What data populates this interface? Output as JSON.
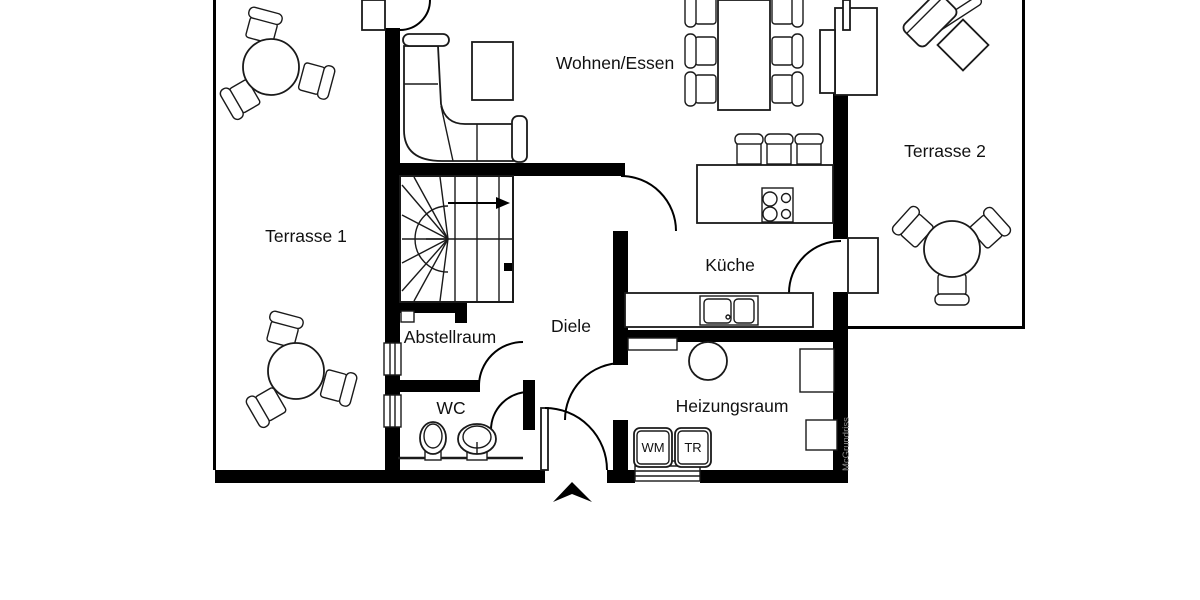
{
  "floorplan": {
    "type": "floor-plan",
    "rooms": {
      "terrasse1": {
        "label": "Terrasse 1"
      },
      "wohnen_essen": {
        "label": "Wohnen/Essen"
      },
      "terrasse2": {
        "label": "Terrasse 2"
      },
      "kueche": {
        "label": "Küche"
      },
      "diele": {
        "label": "Diele"
      },
      "abstellraum": {
        "label": "Abstellraum"
      },
      "wc": {
        "label": "WC"
      },
      "heizungsraum": {
        "label": "Heizungsraum"
      }
    },
    "appliances": {
      "washing_machine": {
        "label": "WM"
      },
      "dryer": {
        "label": "TR"
      }
    },
    "watermark": "McGrundriss",
    "colors": {
      "wall": "#000000",
      "floor": "#ffffff",
      "line": "#1a1a1a",
      "watermark": "#8c8c8c"
    }
  }
}
